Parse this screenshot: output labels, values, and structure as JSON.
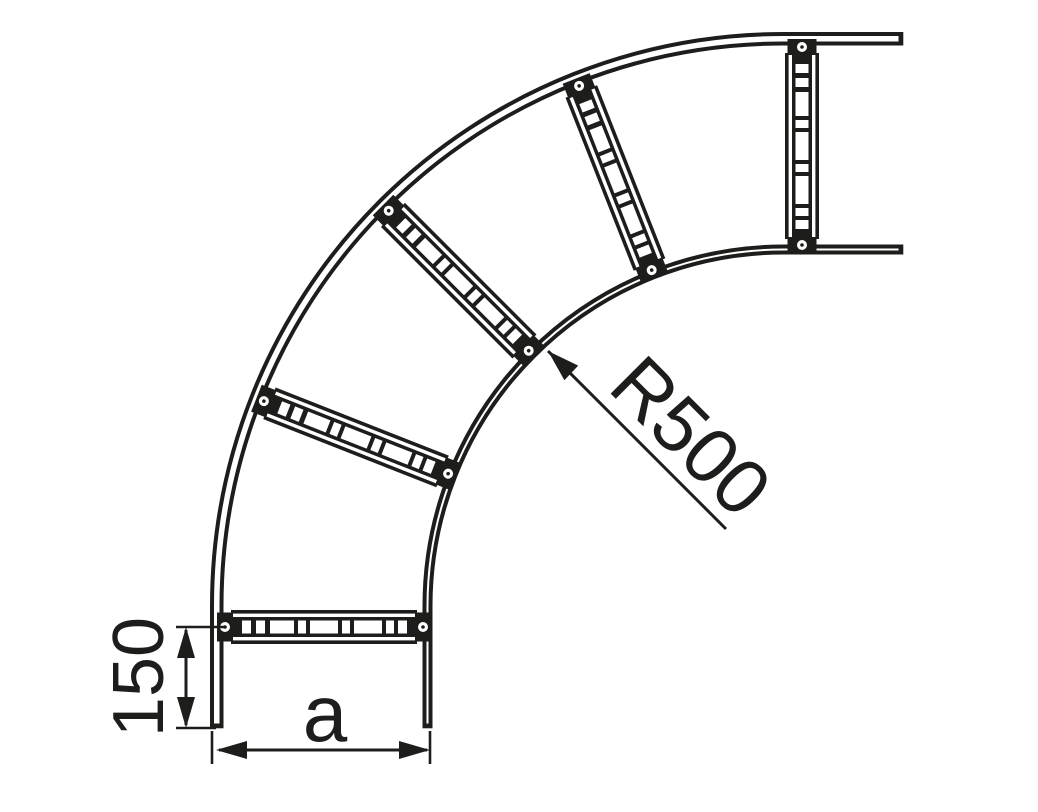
{
  "drawing": {
    "figure": "cable-ladder-90-degree-bend-plan-view",
    "background_color": "#ffffff",
    "line_color": "#1d1d1b",
    "bend_angle_deg": 90,
    "rung_count": 5,
    "labels": {
      "radius": "R500",
      "end_rung_distance": "150",
      "width": "a"
    }
  }
}
